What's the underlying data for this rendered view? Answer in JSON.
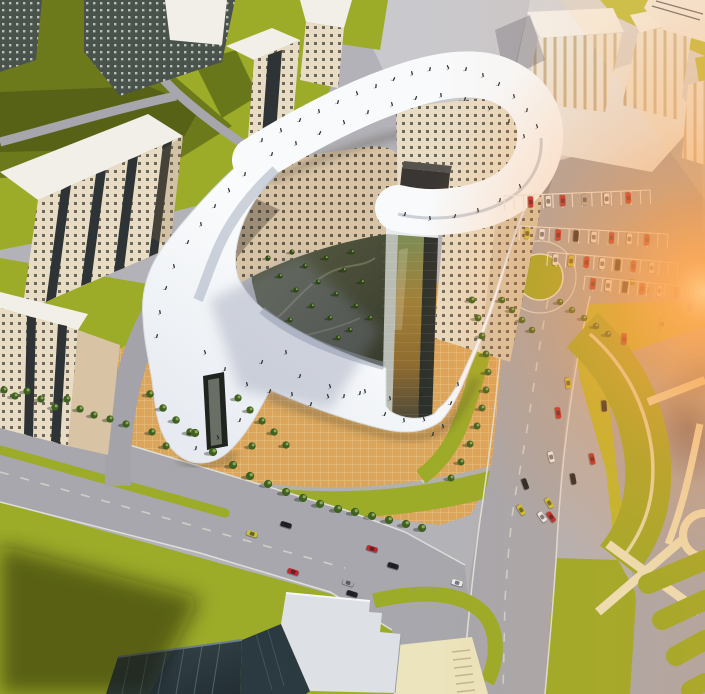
{
  "scene_kind": "aerial-architecture-render",
  "palette": {
    "base": "#b2b2b8",
    "road": "#a7a7ad",
    "road_light": "#c9c9cd",
    "plaza_light": "#d6d6d9",
    "lawn": "#9cab28",
    "lawn_bright": "#b9bb2e",
    "lawn_shadow": "#6a7a1f",
    "path_cream": "#ece4bd",
    "plaza_orange": "#dba55b",
    "cream": "#e9dcc3",
    "cream_shade": "#d8c3a4",
    "roof_white": "#f2efe9",
    "ribbon": "#f8fafc",
    "ribbon_shade": "#c3cad4",
    "glass_dark": "#2d312c",
    "box_dark": "#393633",
    "courtyard": "#50543f",
    "tree_green": "#3f611f",
    "tree_dark": "#2c4617",
    "tree_olive": "#7c7c2c",
    "purple": "#4a3f55",
    "glow": "#ff9440",
    "car_red": "#c1272d",
    "car_yellow": "#cdc032",
    "car_white": "#ececee",
    "car_black": "#232327",
    "car_silver": "#a6a9ad"
  },
  "scene_objects": {
    "cars": [
      [
        690,
        306,
        100,
        "red"
      ],
      [
        662,
        324,
        96,
        "yellow"
      ],
      [
        624,
        339,
        92,
        "red"
      ],
      [
        604,
        406,
        86,
        "black"
      ],
      [
        568,
        383,
        84,
        "yellow"
      ],
      [
        558,
        413,
        82,
        "red"
      ],
      [
        573,
        479,
        80,
        "black"
      ],
      [
        592,
        459,
        78,
        "red"
      ],
      [
        551,
        457,
        76,
        "white"
      ],
      [
        525,
        484,
        70,
        "black"
      ],
      [
        549,
        503,
        58,
        "yellow"
      ],
      [
        542,
        517,
        54,
        "white"
      ],
      [
        551,
        517,
        54,
        "red"
      ],
      [
        521,
        510,
        58,
        "yellow"
      ],
      [
        372,
        549,
        17,
        "red"
      ],
      [
        393,
        566,
        17,
        "black"
      ],
      [
        457,
        583,
        15,
        "white"
      ],
      [
        252,
        534,
        17,
        "yellow"
      ],
      [
        286,
        525,
        17,
        "black"
      ],
      [
        293,
        572,
        17,
        "red"
      ],
      [
        348,
        583,
        17,
        "silver"
      ],
      [
        352,
        594,
        17,
        "black"
      ]
    ],
    "parking_rows": [
      {
        "x0": 504,
        "y0": 196,
        "x1": 650,
        "y1": 190,
        "ticks": 15,
        "cars": [
          [
            0.18,
            "red"
          ],
          [
            0.3,
            "white"
          ],
          [
            0.4,
            "red"
          ],
          [
            0.55,
            "silver"
          ],
          [
            0.7,
            "white"
          ],
          [
            0.85,
            "red"
          ]
        ]
      },
      {
        "x0": 520,
        "y0": 226,
        "x1": 668,
        "y1": 234,
        "ticks": 15,
        "cars": [
          [
            0.05,
            "yellow"
          ],
          [
            0.15,
            "white"
          ],
          [
            0.26,
            "red"
          ],
          [
            0.38,
            "black"
          ],
          [
            0.5,
            "white"
          ],
          [
            0.62,
            "red"
          ],
          [
            0.74,
            "white"
          ],
          [
            0.86,
            "red"
          ]
        ]
      },
      {
        "x0": 548,
        "y0": 252,
        "x1": 678,
        "y1": 263,
        "ticks": 14,
        "cars": [
          [
            0.06,
            "white"
          ],
          [
            0.18,
            "yellow"
          ],
          [
            0.3,
            "red"
          ],
          [
            0.42,
            "white"
          ],
          [
            0.54,
            "black"
          ],
          [
            0.66,
            "red"
          ],
          [
            0.8,
            "white"
          ]
        ]
      },
      {
        "x0": 585,
        "y0": 276,
        "x1": 692,
        "y1": 287,
        "ticks": 12,
        "cars": [
          [
            0.08,
            "red"
          ],
          [
            0.22,
            "white"
          ],
          [
            0.38,
            "black"
          ],
          [
            0.54,
            "red"
          ],
          [
            0.7,
            "white"
          ],
          [
            0.86,
            "red"
          ]
        ]
      }
    ],
    "trees": [
      [
        268,
        258,
        0.8,
        "d"
      ],
      [
        280,
        276,
        0.8,
        "d"
      ],
      [
        292,
        252,
        0.8,
        "d"
      ],
      [
        296,
        290,
        0.8,
        "d"
      ],
      [
        305,
        266,
        0.8,
        "d"
      ],
      [
        312,
        306,
        0.8,
        "d"
      ],
      [
        318,
        282,
        0.8,
        "d"
      ],
      [
        326,
        258,
        0.8,
        "d"
      ],
      [
        330,
        318,
        0.8,
        "d"
      ],
      [
        336,
        294,
        0.8,
        "d"
      ],
      [
        344,
        270,
        0.8,
        "d"
      ],
      [
        350,
        330,
        0.8,
        "d"
      ],
      [
        356,
        306,
        0.8,
        "d"
      ],
      [
        362,
        282,
        0.8,
        "d"
      ],
      [
        370,
        318,
        0.8,
        "d"
      ],
      [
        352,
        252,
        0.8,
        "d"
      ],
      [
        338,
        338,
        0.8,
        "d"
      ],
      [
        290,
        320,
        0.8,
        "d"
      ],
      [
        150,
        394,
        1.15,
        "g"
      ],
      [
        163,
        408,
        1.15,
        "g"
      ],
      [
        176,
        420,
        1.15,
        "g"
      ],
      [
        190,
        432,
        1.15,
        "g"
      ],
      [
        152,
        432,
        1.1,
        "g"
      ],
      [
        166,
        446,
        1.1,
        "g"
      ],
      [
        238,
        398,
        1.1,
        "g"
      ],
      [
        250,
        410,
        1.1,
        "g"
      ],
      [
        262,
        421,
        1.1,
        "g"
      ],
      [
        274,
        432,
        1.1,
        "g"
      ],
      [
        252,
        446,
        1.1,
        "g"
      ],
      [
        286,
        445,
        1.1,
        "g"
      ],
      [
        472,
        300,
        1.05,
        "g"
      ],
      [
        478,
        318,
        1.05,
        "g"
      ],
      [
        482,
        336,
        1.05,
        "g"
      ],
      [
        486,
        354,
        1.05,
        "g"
      ],
      [
        488,
        372,
        1.05,
        "g"
      ],
      [
        486,
        390,
        1.05,
        "g"
      ],
      [
        482,
        408,
        1.05,
        "g"
      ],
      [
        477,
        426,
        1.05,
        "g"
      ],
      [
        470,
        444,
        1.05,
        "g"
      ],
      [
        461,
        462,
        1.05,
        "g"
      ],
      [
        451,
        478,
        1.05,
        "g"
      ],
      [
        195,
        433,
        1.25,
        "g"
      ],
      [
        213,
        452,
        1.25,
        "g"
      ],
      [
        233,
        465,
        1.25,
        "g"
      ],
      [
        250,
        476,
        1.25,
        "g"
      ],
      [
        268,
        484,
        1.25,
        "g"
      ],
      [
        286,
        492,
        1.25,
        "g"
      ],
      [
        303,
        498,
        1.25,
        "g"
      ],
      [
        320,
        504,
        1.25,
        "g"
      ],
      [
        338,
        509,
        1.25,
        "g"
      ],
      [
        355,
        512,
        1.25,
        "g"
      ],
      [
        372,
        516,
        1.25,
        "g"
      ],
      [
        389,
        520,
        1.25,
        "g"
      ],
      [
        406,
        524,
        1.25,
        "g"
      ],
      [
        422,
        528,
        1.25,
        "g"
      ],
      [
        4,
        390,
        1.1,
        "g"
      ],
      [
        15,
        396,
        1.1,
        "g"
      ],
      [
        27,
        391,
        1.1,
        "g"
      ],
      [
        41,
        399,
        1.1,
        "g"
      ],
      [
        55,
        407,
        1.1,
        "g"
      ],
      [
        67,
        399,
        1.1,
        "g"
      ],
      [
        80,
        409,
        1.1,
        "g"
      ],
      [
        94,
        415,
        1.1,
        "g"
      ],
      [
        110,
        419,
        1.1,
        "g"
      ],
      [
        126,
        424,
        1.1,
        "g"
      ],
      [
        502,
        300,
        1.0,
        "g"
      ],
      [
        512,
        310,
        1.0,
        "g"
      ],
      [
        522,
        320,
        1.0,
        "g"
      ],
      [
        532,
        330,
        1.0,
        "g"
      ],
      [
        560,
        302,
        1.0,
        "g"
      ],
      [
        572,
        310,
        1.0,
        "g"
      ],
      [
        584,
        318,
        1.0,
        "g"
      ],
      [
        596,
        326,
        1.0,
        "g"
      ],
      [
        608,
        334,
        1.0,
        "g"
      ],
      [
        632,
        282,
        1.0,
        "o"
      ],
      [
        646,
        290,
        1.0,
        "o"
      ]
    ],
    "people": [
      [
        262,
        140,
        10
      ],
      [
        281,
        130,
        -15
      ],
      [
        300,
        120,
        20
      ],
      [
        319,
        111,
        -10
      ],
      [
        338,
        102,
        15
      ],
      [
        357,
        93,
        -20
      ],
      [
        376,
        86,
        5
      ],
      [
        394,
        79,
        25
      ],
      [
        412,
        73,
        -15
      ],
      [
        430,
        69,
        10
      ],
      [
        448,
        67,
        -25
      ],
      [
        466,
        69,
        15
      ],
      [
        483,
        75,
        -10
      ],
      [
        499,
        84,
        20
      ],
      [
        514,
        96,
        -15
      ],
      [
        527,
        110,
        10
      ],
      [
        537,
        126,
        -20
      ],
      [
        272,
        154,
        15
      ],
      [
        296,
        143,
        -10
      ],
      [
        320,
        133,
        25
      ],
      [
        344,
        122,
        -20
      ],
      [
        368,
        112,
        10
      ],
      [
        392,
        104,
        -15
      ],
      [
        416,
        98,
        20
      ],
      [
        441,
        95,
        -10
      ],
      [
        465,
        99,
        15
      ],
      [
        489,
        108,
        -25
      ],
      [
        509,
        121,
        10
      ],
      [
        524,
        136,
        -15
      ],
      [
        188,
        242,
        20
      ],
      [
        201,
        224,
        -10
      ],
      [
        215,
        206,
        15
      ],
      [
        229,
        190,
        -20
      ],
      [
        245,
        174,
        10
      ],
      [
        174,
        266,
        -15
      ],
      [
        166,
        288,
        20
      ],
      [
        160,
        312,
        -10
      ],
      [
        157,
        336,
        15
      ],
      [
        520,
        186,
        -20
      ],
      [
        500,
        200,
        10
      ],
      [
        478,
        210,
        -15
      ],
      [
        455,
        216,
        20
      ],
      [
        430,
        218,
        -10
      ],
      [
        405,
        214,
        15
      ],
      [
        205,
        352,
        -20
      ],
      [
        225,
        369,
        10
      ],
      [
        247,
        384,
        -15
      ],
      [
        270,
        391,
        20
      ],
      [
        292,
        394,
        -10
      ],
      [
        311,
        404,
        15
      ],
      [
        328,
        396,
        -20
      ],
      [
        344,
        396,
        10
      ],
      [
        365,
        391,
        -15
      ],
      [
        385,
        414,
        20
      ],
      [
        404,
        420,
        -10
      ],
      [
        422,
        394,
        15
      ],
      [
        424,
        419,
        -20
      ],
      [
        433,
        434,
        10
      ],
      [
        443,
        426,
        -15
      ],
      [
        451,
        403,
        20
      ],
      [
        458,
        384,
        -10
      ],
      [
        300,
        376,
        15
      ],
      [
        330,
        386,
        -20
      ],
      [
        360,
        393,
        10
      ],
      [
        390,
        398,
        -15
      ],
      [
        262,
        362,
        20
      ],
      [
        286,
        352,
        -10
      ],
      [
        240,
        420,
        15
      ],
      [
        218,
        437,
        -20
      ],
      [
        196,
        448,
        10
      ]
    ]
  }
}
